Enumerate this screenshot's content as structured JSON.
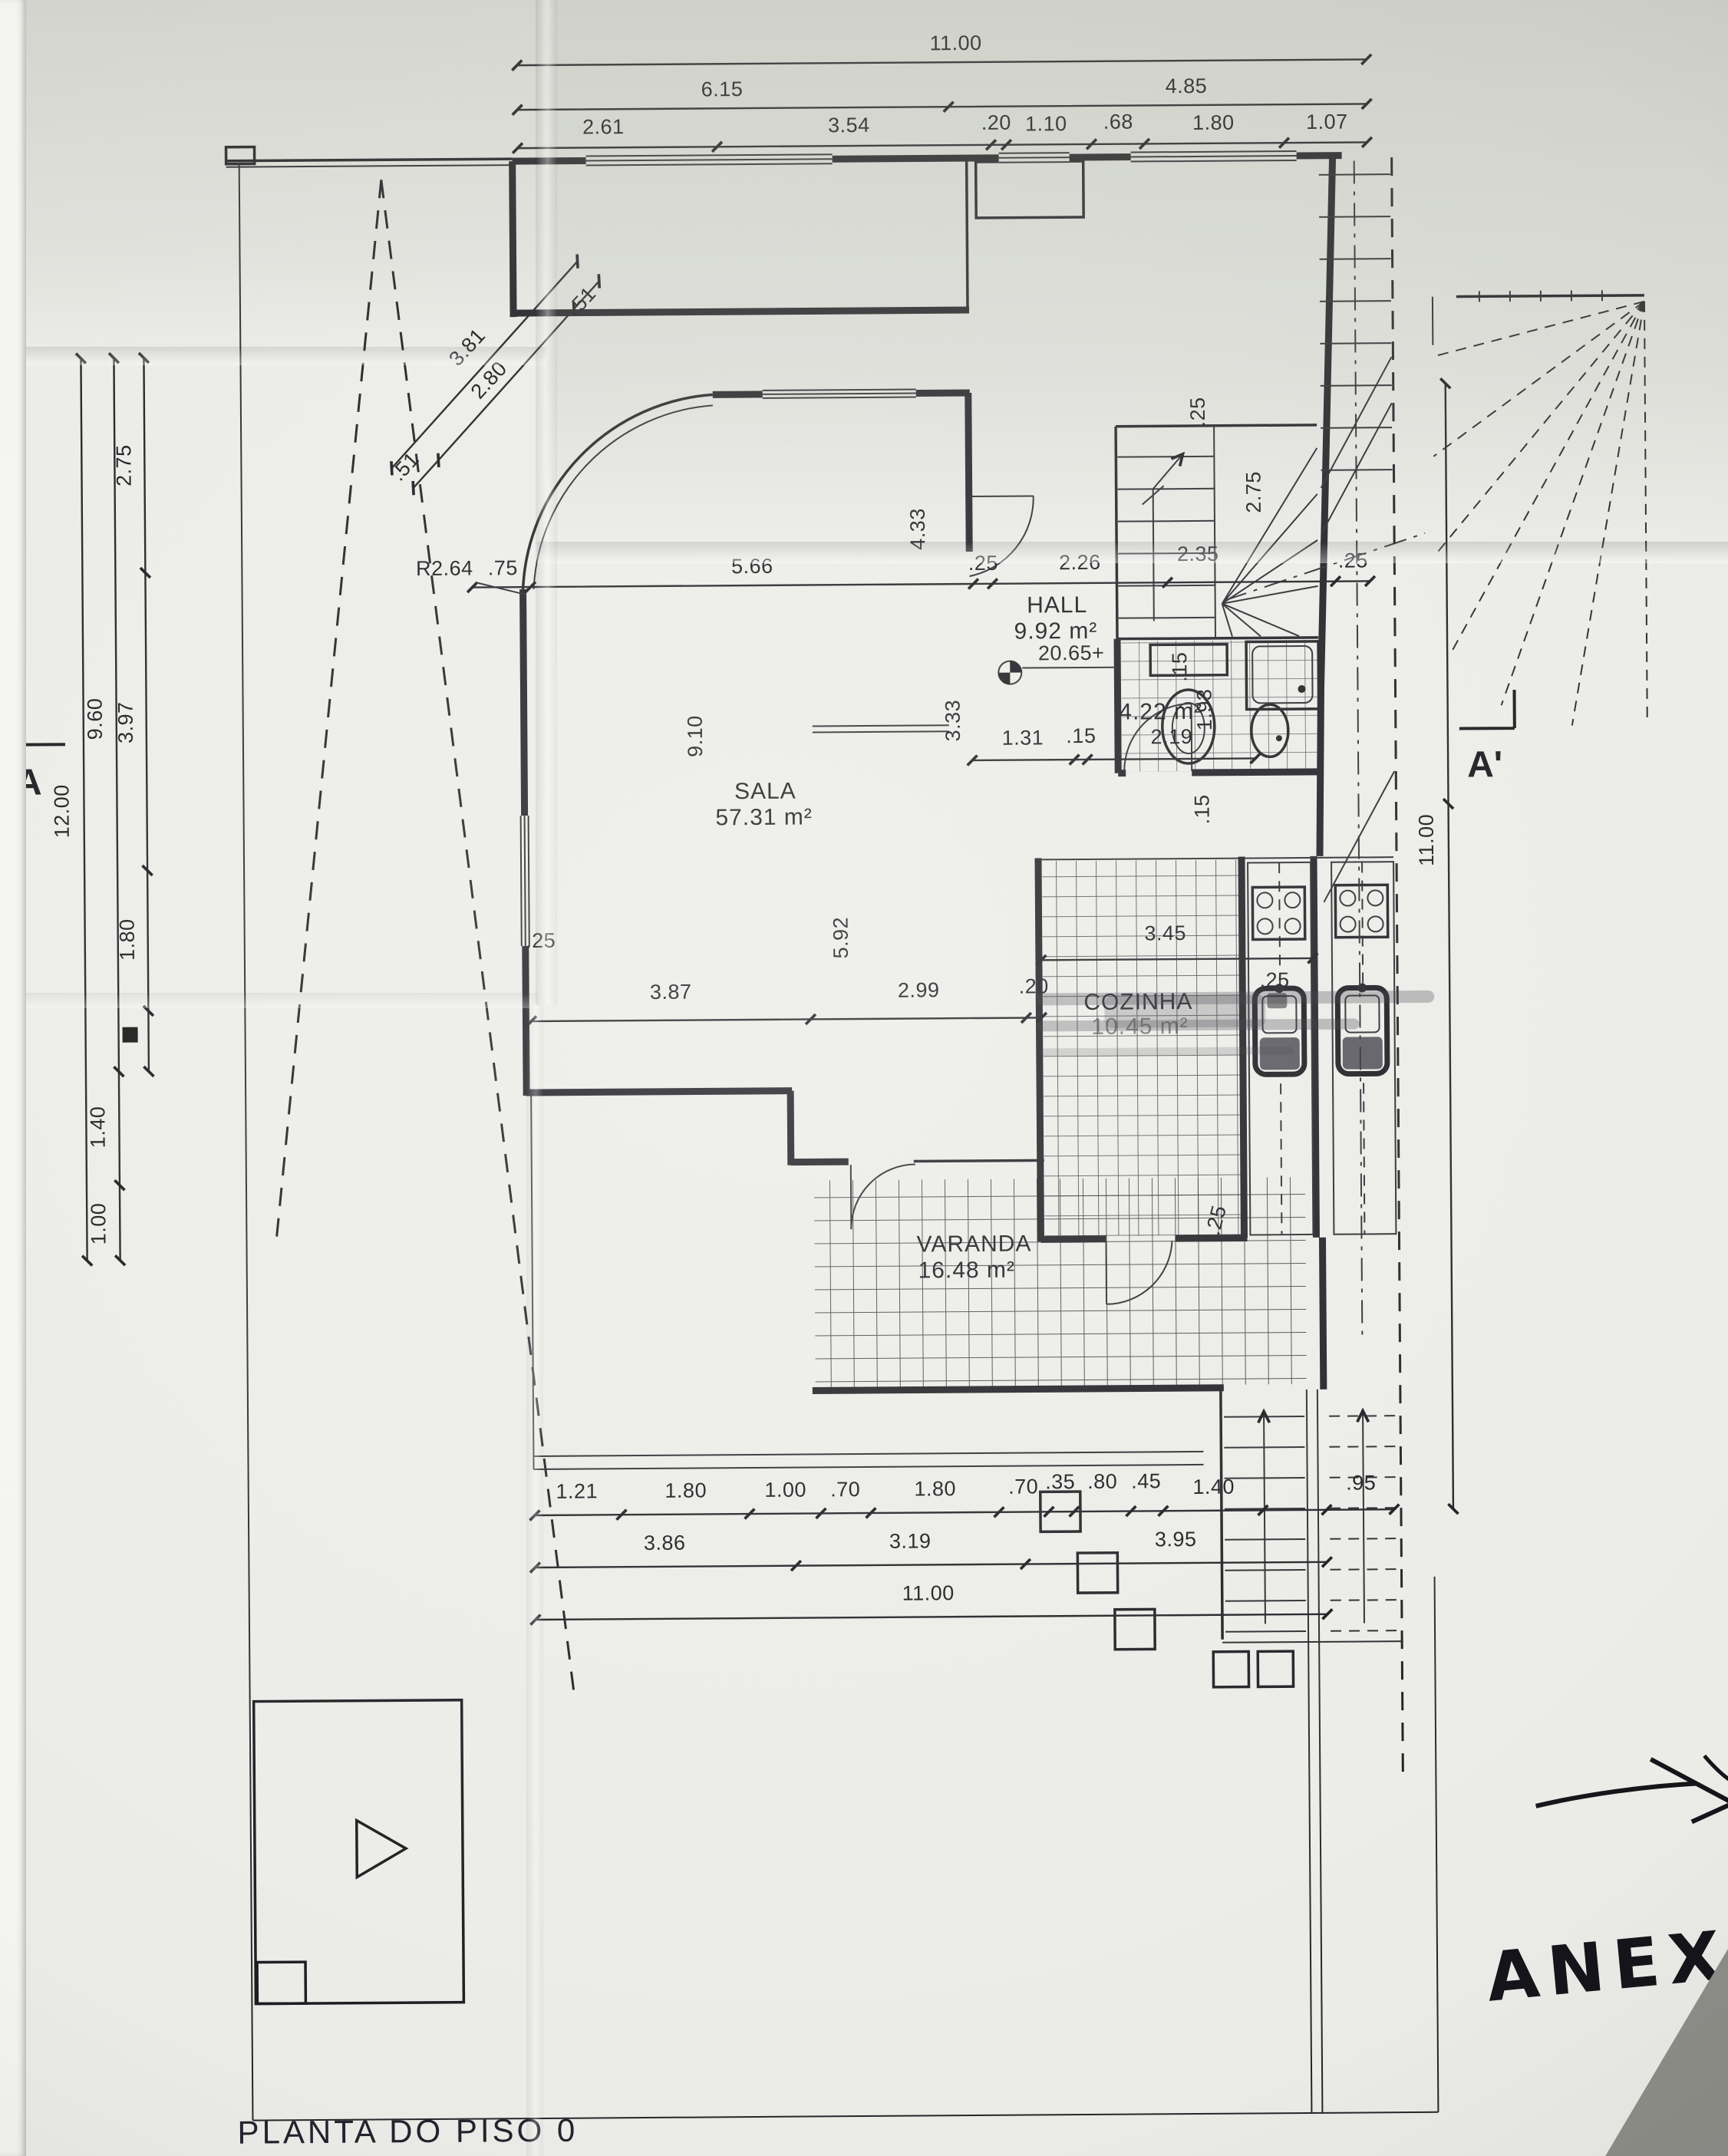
{
  "meta": {
    "title": "PLANTA DO PISO 0",
    "annex_note": "ANEXO"
  },
  "markers": {
    "section_left": "A",
    "section_right": "A'",
    "level": "20.65+",
    "radius": "R2.64"
  },
  "rooms": {
    "sala": {
      "name": "SALA",
      "area": "57.31 m²"
    },
    "hall": {
      "name": "HALL",
      "area": "9.92 m²"
    },
    "cozinha": {
      "name": "COZINHA",
      "area": "10.45 m²"
    },
    "varanda": {
      "name": "VARANDA",
      "area": "16.48 m²"
    },
    "wc": {
      "area": "4.22 m²"
    }
  },
  "labels": {
    "top_total": "11.00",
    "top_a": "6.15",
    "top_b": "4.85",
    "t3_1": "2.61",
    "t3_2": "3.54",
    "t3_3": ".20",
    "t3_4": "1.10",
    "t3_5": ".68",
    "t3_6": "1.80",
    "t3_7": "1.07",
    "left_total": "12.00",
    "left_a": "9.60",
    "left_b": "1.40",
    "left_c": "1.00",
    "li_a": "2.75",
    "li_b": "3.97",
    "li_c": "1.80",
    "diag_a": "3.81",
    "diag_b": "2.80",
    "diag_t1": ".51",
    "diag_t2": ".51",
    "s75": ".75",
    "s566": "5.66",
    "s25a": ".25",
    "s226": "2.26",
    "s25r": ".25",
    "v433": "4.33",
    "v333": "3.33",
    "v910": "9.10",
    "v592": "5.92",
    "wc_a": "1.31",
    "wc_b": ".15",
    "wc_c": "2.19",
    "wc_d": "1.93",
    "wc_e": ".15",
    "st_25t": ".25",
    "st_235": "2.35",
    "st_275": "2.75",
    "st_15": ".15",
    "m25": ".25",
    "m387": "3.87",
    "m299": "2.99",
    "m20": ".20",
    "k345": "3.45",
    "k25a": ".25",
    "k25b": ".25",
    "b1_1": "1.21",
    "b1_2": "1.80",
    "b1_3": "1.00",
    "b1_4": ".70",
    "b1_5": "1.80",
    "b1_6": ".70",
    "b1_7": ".35",
    "b1_8": ".80",
    "b1_9": ".45",
    "b1_10": "1.40",
    "b1_11": ".95",
    "b2_1": "3.86",
    "b2_2": "3.19",
    "b2_3": "3.95",
    "b3": "11.00",
    "right_total": "11.00"
  }
}
